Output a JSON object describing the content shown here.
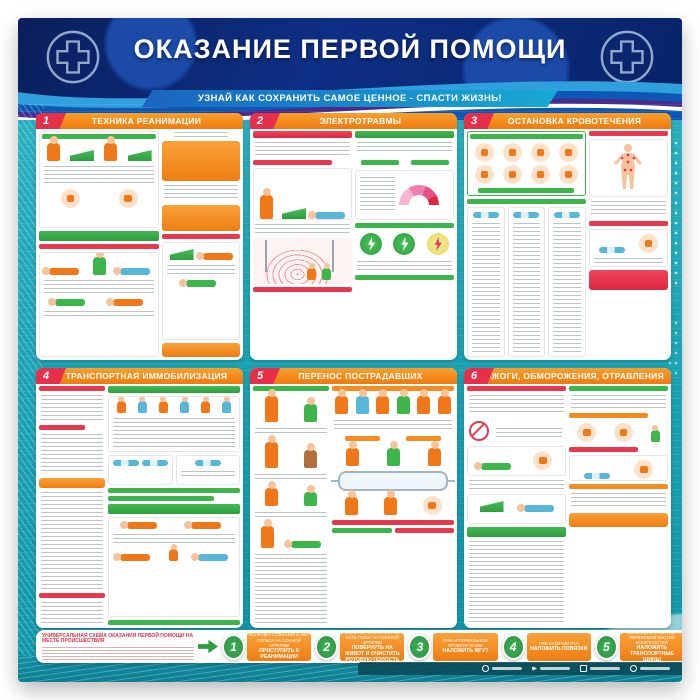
{
  "poster": {
    "title": "ОКАЗАНИЕ ПЕРВОЙ ПОМОЩИ",
    "subtitle": "УЗНАЙ КАК СОХРАНИТЬ САМОЕ ЦЕННОЕ - СПАСТИ ЖИЗНЬ!",
    "panels": [
      {
        "number": "1",
        "title": "ТЕХНИКА РЕАНИМАЦИИ"
      },
      {
        "number": "2",
        "title": "ЭЛЕКТРОТРАВМЫ"
      },
      {
        "number": "3",
        "title": "ОСТАНОВКА КРОВОТЕЧЕНИЯ"
      },
      {
        "number": "4",
        "title": "ТРАНСПОРТНАЯ ИММОБИЛИЗАЦИЯ"
      },
      {
        "number": "5",
        "title": "ПЕРЕНОС ПОСТРАДАВШИХ"
      },
      {
        "number": "6",
        "title": "ОЖОГИ, ОБМОРОЖЕНИЯ, ОТРАВЛЕНИЯ"
      }
    ],
    "scheme": {
      "title": "УНИВЕРСАЛЬНАЯ СХЕМА ОКАЗАНИЯ ПЕРВОЙ ПОМОЩИ НА МЕСТЕ ПРОИСШЕСТВИЯ",
      "steps": [
        {
          "number": "1",
          "condition": "Если нет сознания и нет пульса на сонной артерии",
          "action": "ПРИСТУПИТЬ К РЕАНИМАЦИИ"
        },
        {
          "number": "2",
          "condition": "Если нет сознания, но есть пульс на сонной артерии",
          "action": "ПОВЕРНУТЬ НА ЖИВОТ И ОЧИСТИТЬ РОТОВУЮ ПОЛОСТЬ"
        },
        {
          "number": "3",
          "condition": "При артериальном кровотечении",
          "action": "НАЛОЖИТЬ ЖГУТ"
        },
        {
          "number": "4",
          "condition": "При наличии ран",
          "action": "НАЛОЖИТЬ ПОВЯЗКИ"
        },
        {
          "number": "5",
          "condition": "Если есть признаки переломов костей конечностей",
          "action": "НАЛОЖИТЬ ТРАНСПОРТНЫЕ ШИНЫ"
        }
      ]
    },
    "colors": {
      "header_blue": "#0d2f85",
      "teal_background": "#1aa2b3",
      "panel_header_orange": "#f68b1f",
      "number_badge_red": "#e63049",
      "accent_green": "#2e9e3f",
      "banner_blue": "#17a9d2"
    }
  }
}
